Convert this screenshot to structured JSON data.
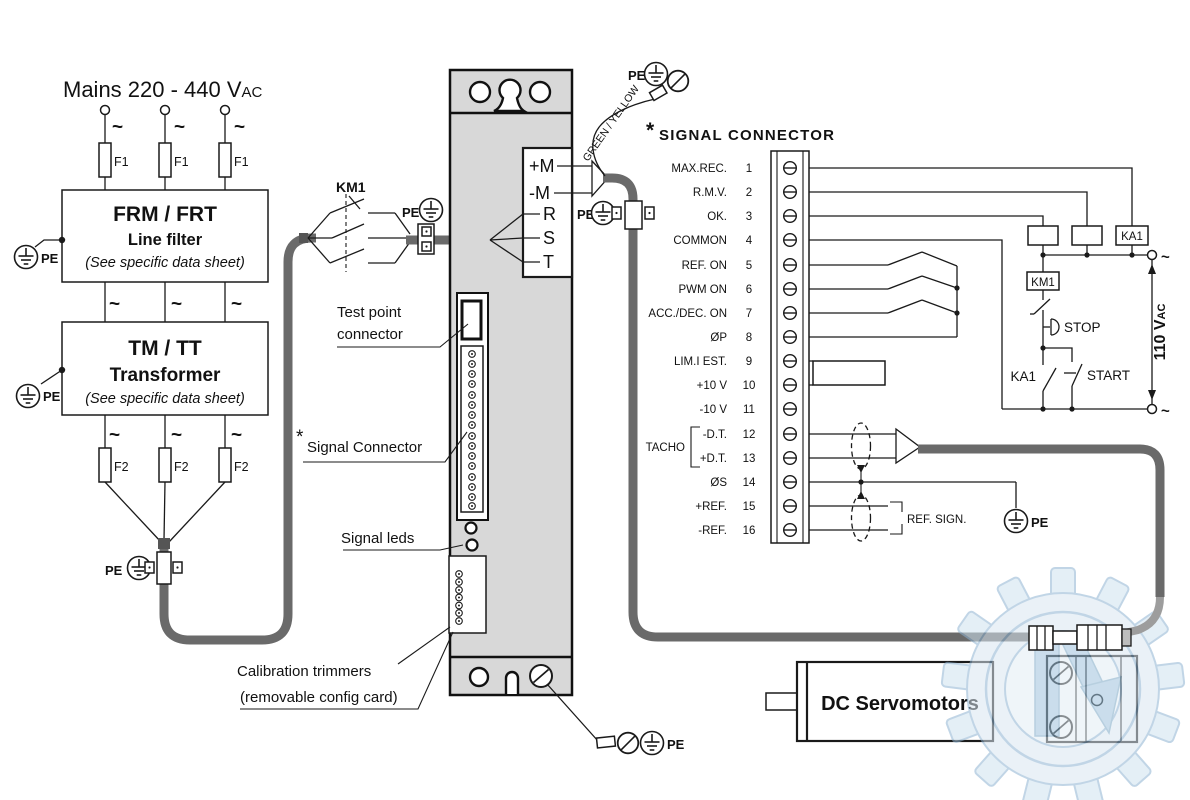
{
  "mains": {
    "title": "Mains 220 - 440 V",
    "title_sub": "AC",
    "tilde": "~",
    "fuse1": "F1",
    "fuse2": "F2"
  },
  "pe": "PE",
  "filter": {
    "model": "FRM / FRT",
    "name": "Line filter",
    "note": "(See specific data sheet)"
  },
  "transformer": {
    "model": "TM / TT",
    "name": "Transformer",
    "note": "(See specific data sheet)"
  },
  "km1": "KM1",
  "drive_labels": {
    "test_point_1": "Test point",
    "test_point_2": "connector",
    "asterisk": "*",
    "signal_connector": "Signal Connector",
    "signal_leds": "Signal leds",
    "calibration_1": "Calibration trimmers",
    "calibration_2": "(removable config card)"
  },
  "power_terminals": {
    "plus_m": "+M",
    "minus_m": "-M",
    "r": "R",
    "s": "S",
    "t": "T"
  },
  "green_yellow": "GREEN / YELLOW",
  "connector": {
    "asterisk": "*",
    "heading": "SIGNAL  CONNECTOR",
    "tacho": "TACHO",
    "rows": [
      {
        "label": "MAX.REC.",
        "num": "1"
      },
      {
        "label": "R.M.V.",
        "num": "2"
      },
      {
        "label": "OK.",
        "num": "3"
      },
      {
        "label": "COMMON",
        "num": "4"
      },
      {
        "label": "REF. ON",
        "num": "5"
      },
      {
        "label": "PWM ON",
        "num": "6"
      },
      {
        "label": "ACC./DEC. ON",
        "num": "7"
      },
      {
        "label": "ØP",
        "num": "8"
      },
      {
        "label": "LIM.I EST.",
        "num": "9"
      },
      {
        "label": "+10 V",
        "num": "10"
      },
      {
        "label": "-10 V",
        "num": "11"
      },
      {
        "label": "-D.T.",
        "num": "12"
      },
      {
        "label": "+D.T.",
        "num": "13"
      },
      {
        "label": "ØS",
        "num": "14"
      },
      {
        "label": "+REF.",
        "num": "15"
      },
      {
        "label": "-REF.",
        "num": "16"
      }
    ]
  },
  "control": {
    "ka1_coil": "KA1",
    "km1_coil": "KM1",
    "ka1_contact": "KA1",
    "stop": "STOP",
    "start": "START",
    "voltage": "110 V",
    "voltage_sub": "AC",
    "tilde": "~"
  },
  "ref_sign": "REF. SIGN.",
  "motor": "DC Servomotors",
  "colors": {
    "module_fill": "#d8d8d8",
    "cable": "#6a6a6a",
    "watermark": "#9fc3dd"
  }
}
